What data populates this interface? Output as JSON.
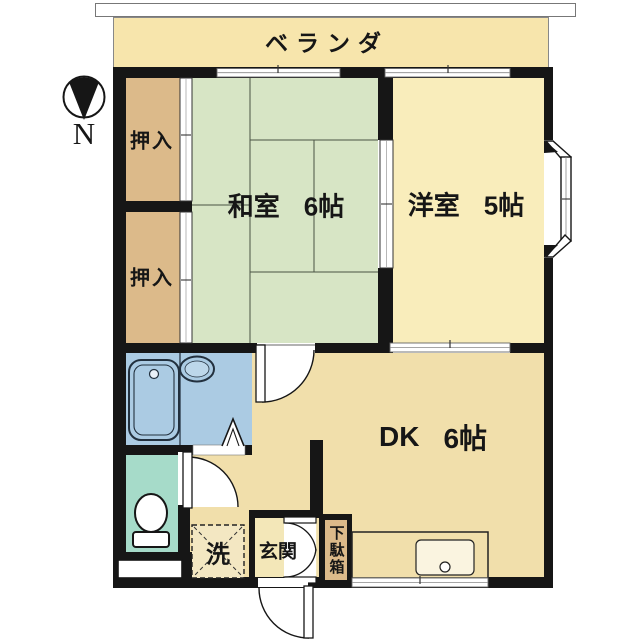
{
  "plan_title": "1DK apartment floor plan",
  "compass": {
    "label": "N"
  },
  "balcony": {
    "label": "ベランダ",
    "color": "#f7e5ac"
  },
  "rooms": {
    "washitsu": {
      "name": "和室",
      "size": "6帖",
      "color": "#d7e5c5"
    },
    "yoshitsu": {
      "name": "洋室",
      "size": "5帖",
      "color": "#f9edbb"
    },
    "dk": {
      "name": "DK",
      "size": "6帖",
      "color": "#f1dfab"
    },
    "closet_top": {
      "label": "押入",
      "color": "#dcba8a"
    },
    "closet_bottom": {
      "label": "押入",
      "color": "#dcba8a"
    },
    "genkan": {
      "label": "玄関",
      "color": "#f3e7b8"
    },
    "laundry": {
      "label": "洗"
    },
    "shoe_cabinet": {
      "label": "下駄箱",
      "color": "#dcba8a"
    },
    "bathroom": {
      "color": "#abcbe3"
    },
    "toilet": {
      "color": "#a6dbc9"
    }
  },
  "colors": {
    "wall": "#161616",
    "outline": "#777777"
  }
}
